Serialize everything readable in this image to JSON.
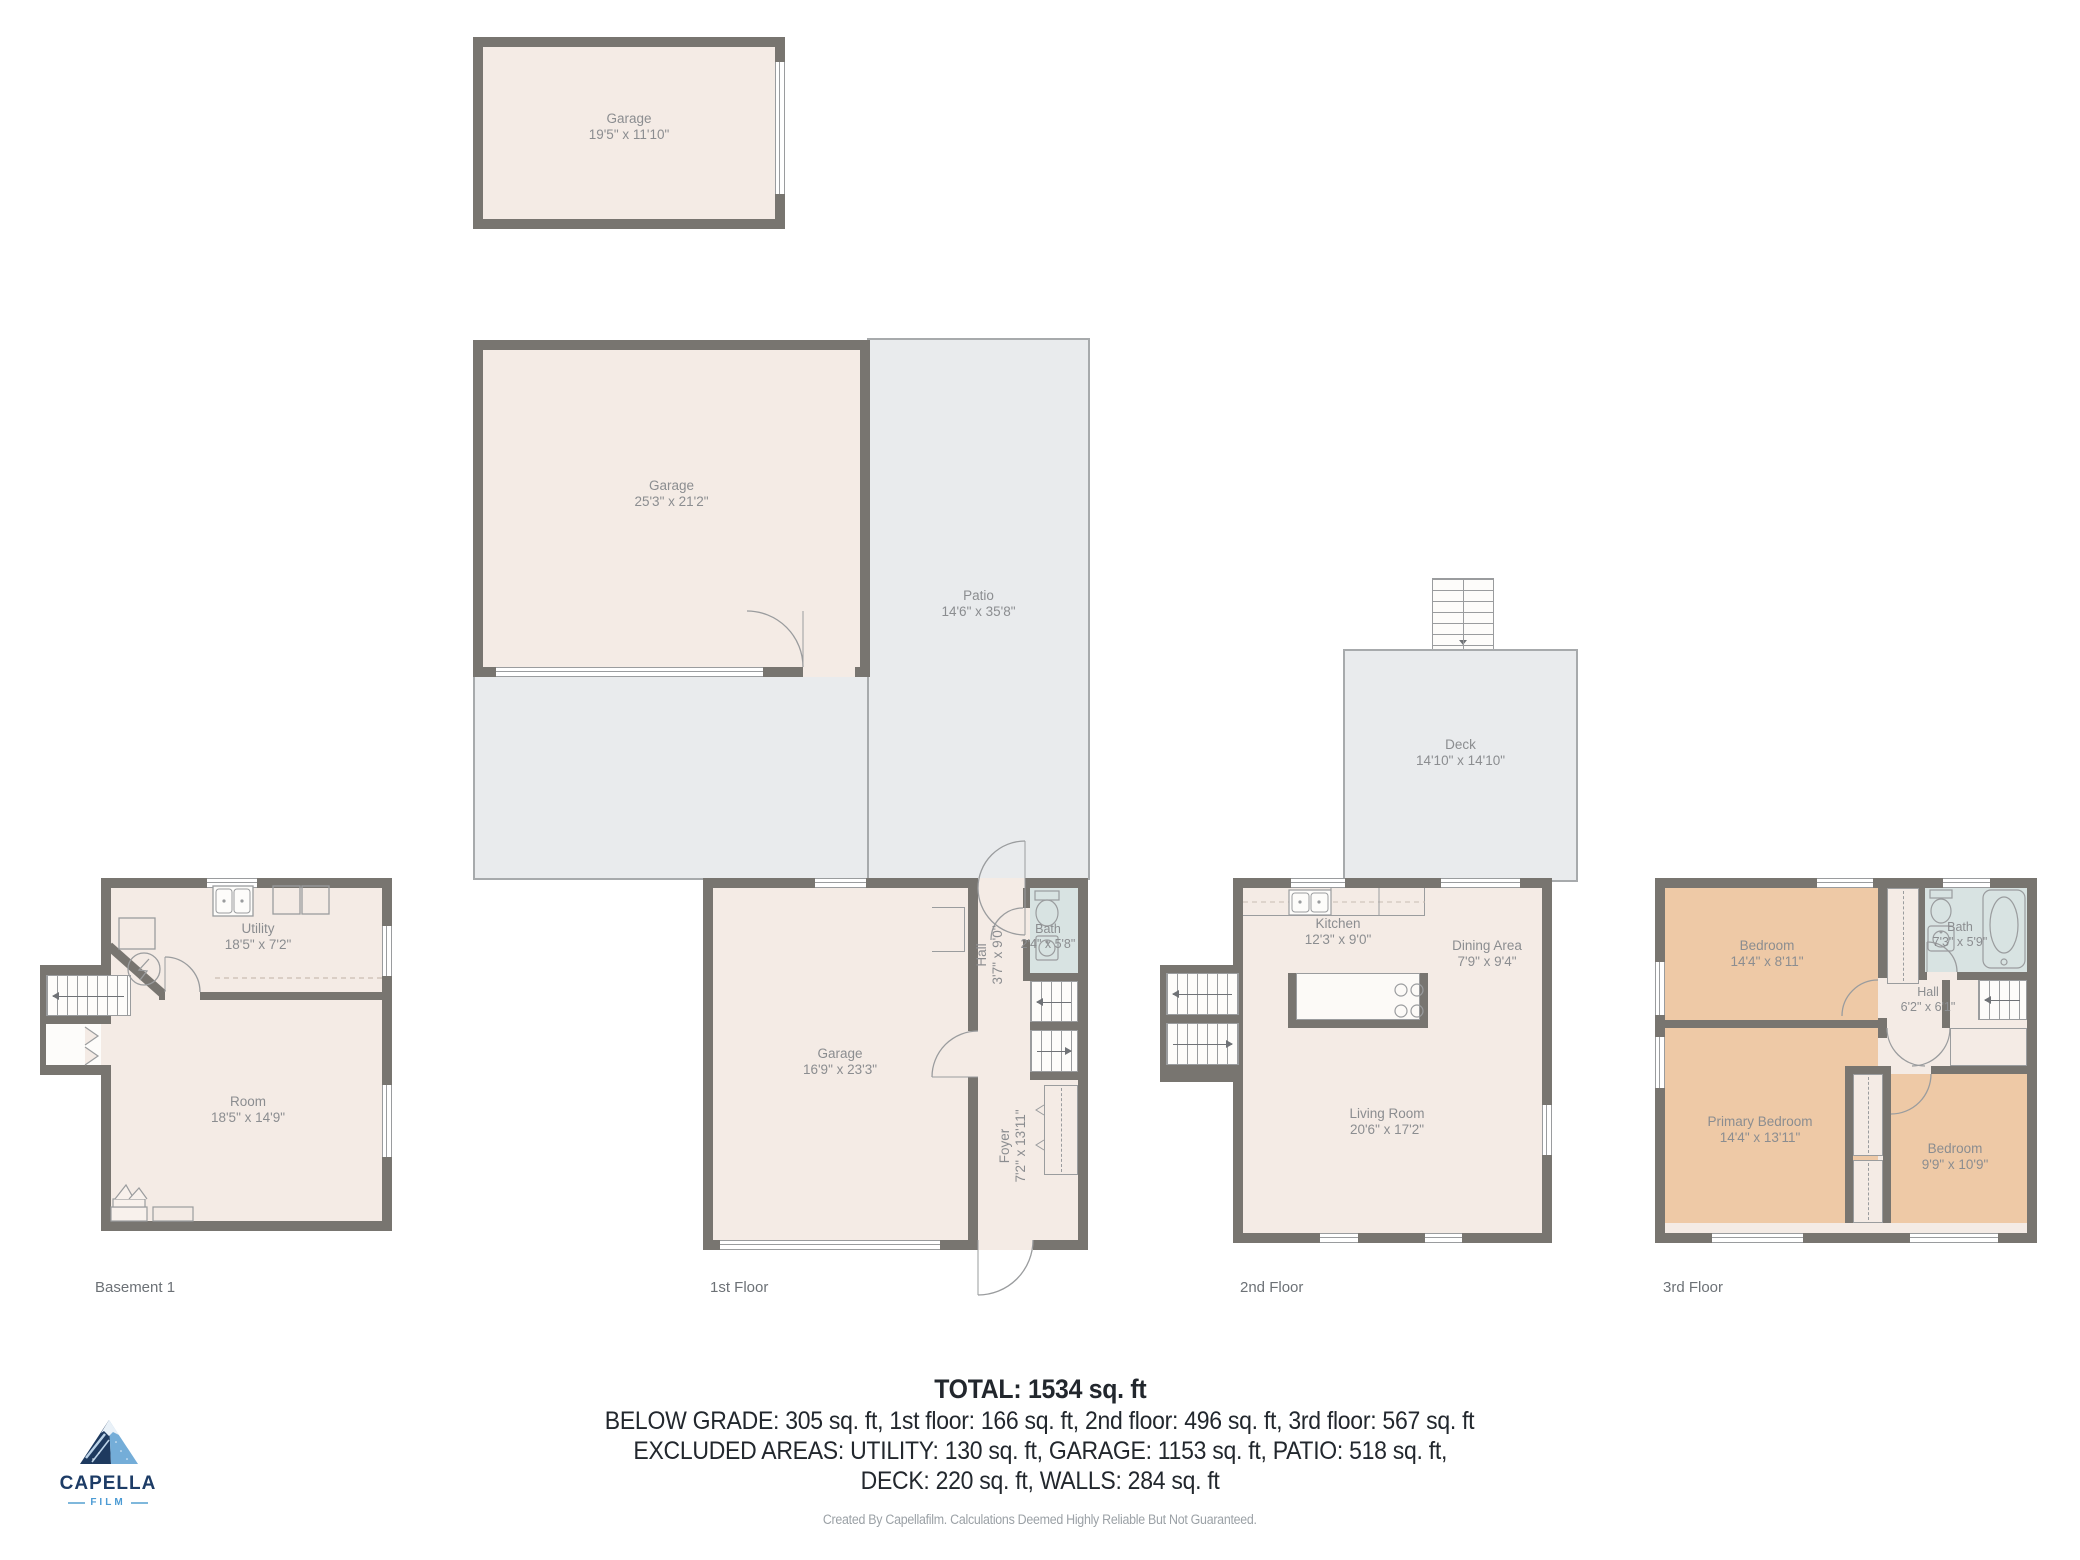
{
  "colors": {
    "wall": "#787570",
    "cream": "#f4ebe5",
    "tan": "#eec9a6",
    "bathblue": "#d8e3e2",
    "gray": "#e9ebed",
    "grayline": "#a7aaac",
    "fixture": "#9a9c9e",
    "label": "#8b8d90",
    "floorlabel": "#6c7176",
    "ink": "#22272d",
    "faint": "#9ba1a6",
    "navy": "#1d3c66",
    "blue": "#4c9bd4"
  },
  "plans": {
    "garage_upper": {
      "rooms": {
        "garage": {
          "name": "Garage",
          "dims": "19'5\" x 11'10\""
        }
      }
    },
    "garage_main": {
      "rooms": {
        "garage": {
          "name": "Garage",
          "dims": "25'3\" x 21'2\""
        },
        "patio": {
          "name": "Patio",
          "dims": "14'6\" x 35'8\""
        }
      }
    },
    "deck": {
      "rooms": {
        "deck": {
          "name": "Deck",
          "dims": "14'10\" x 14'10\""
        }
      }
    },
    "basement": {
      "label": "Basement 1",
      "rooms": {
        "utility": {
          "name": "Utility",
          "dims": "18'5\" x 7'2\""
        },
        "room": {
          "name": "Room",
          "dims": "18'5\" x 14'9\""
        }
      }
    },
    "first": {
      "label": "1st Floor",
      "rooms": {
        "garage": {
          "name": "Garage",
          "dims": "16'9\" x 23'3\""
        },
        "hall": {
          "name": "Hall",
          "dims": "3'7\" x 9'0\""
        },
        "bath": {
          "name": "Bath",
          "dims": "2'4\" x 5'8\""
        },
        "foyer": {
          "name": "Foyer",
          "dims": "7'2\" x 13'11\""
        }
      }
    },
    "second": {
      "label": "2nd Floor",
      "rooms": {
        "kitchen": {
          "name": "Kitchen",
          "dims": "12'3\" x 9'0\""
        },
        "dining": {
          "name": "Dining Area",
          "dims": "7'9\" x 9'4\""
        },
        "living": {
          "name": "Living Room",
          "dims": "20'6\" x 17'2\""
        }
      }
    },
    "third": {
      "label": "3rd Floor",
      "rooms": {
        "bedroom1": {
          "name": "Bedroom",
          "dims": "14'4\" x 8'11\""
        },
        "bath": {
          "name": "Bath",
          "dims": "7'3\" x 5'9\""
        },
        "hall": {
          "name": "Hall",
          "dims": "6'2\" x 6'1\""
        },
        "primary": {
          "name": "Primary Bedroom",
          "dims": "14'4\" x 13'11\""
        },
        "bedroom2": {
          "name": "Bedroom",
          "dims": "9'9\" x 10'9\""
        }
      }
    }
  },
  "summary": {
    "total": "TOTAL: 1534 sq. ft",
    "line1": "BELOW GRADE: 305 sq. ft, 1st floor: 166 sq. ft, 2nd floor: 496 sq. ft, 3rd floor: 567 sq. ft",
    "line2": "EXCLUDED AREAS: UTILITY: 130 sq. ft, GARAGE: 1153 sq. ft, PATIO: 518 sq. ft,",
    "line3": "DECK: 220 sq. ft, WALLS: 284 sq. ft",
    "disclaimer": "Created By Capellafilm. Calculations Deemed Highly Reliable But Not Guaranteed."
  },
  "logo": {
    "brand": "CAPELLA",
    "sub": "FILM"
  }
}
